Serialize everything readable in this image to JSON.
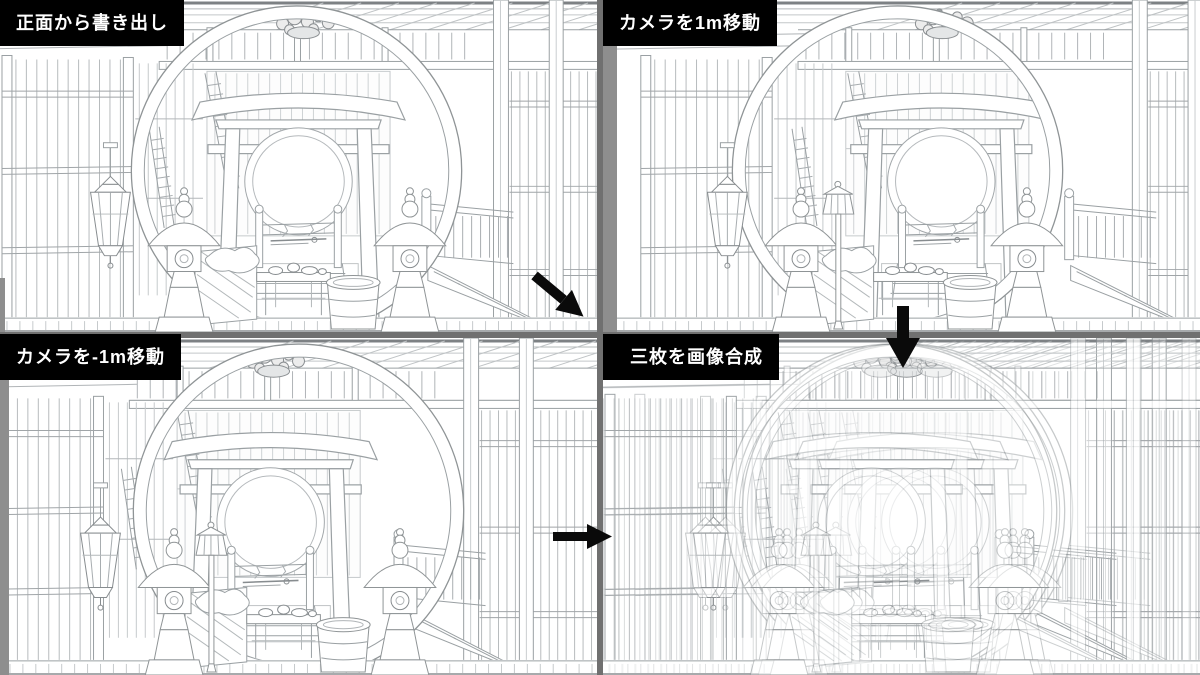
{
  "page": {
    "type": "four-panel line-art comparison collage"
  },
  "panels": [
    {
      "id": "panel-front",
      "label": "正面から書き出し"
    },
    {
      "id": "panel-plus1m",
      "label": "カメラを1m移動"
    },
    {
      "id": "panel-minus1m",
      "label": "カメラを-1m移動"
    },
    {
      "id": "panel-composite",
      "label": "三枚を画像合成"
    }
  ],
  "arrows": [
    {
      "name": "arrow-down-right-icon",
      "direction": "down-right"
    },
    {
      "name": "arrow-down-icon",
      "direction": "down"
    },
    {
      "name": "arrow-right-icon",
      "direction": "right"
    }
  ],
  "scene": {
    "subject": "japanese shrine room with round moon window, torii gate, stone lanterns, table and basin",
    "style": "light gray line-art render on white"
  },
  "colors": {
    "gap_background": "#707070",
    "panel_background": "#ffffff",
    "label_background": "#000000",
    "label_text": "#ffffff",
    "arrow": "#0a0a0a",
    "line_light": "#b3b8ba",
    "line_mid": "#9aa0a3",
    "line_dark": "#878c8f",
    "pillar_gray": "#8e8e8e"
  }
}
